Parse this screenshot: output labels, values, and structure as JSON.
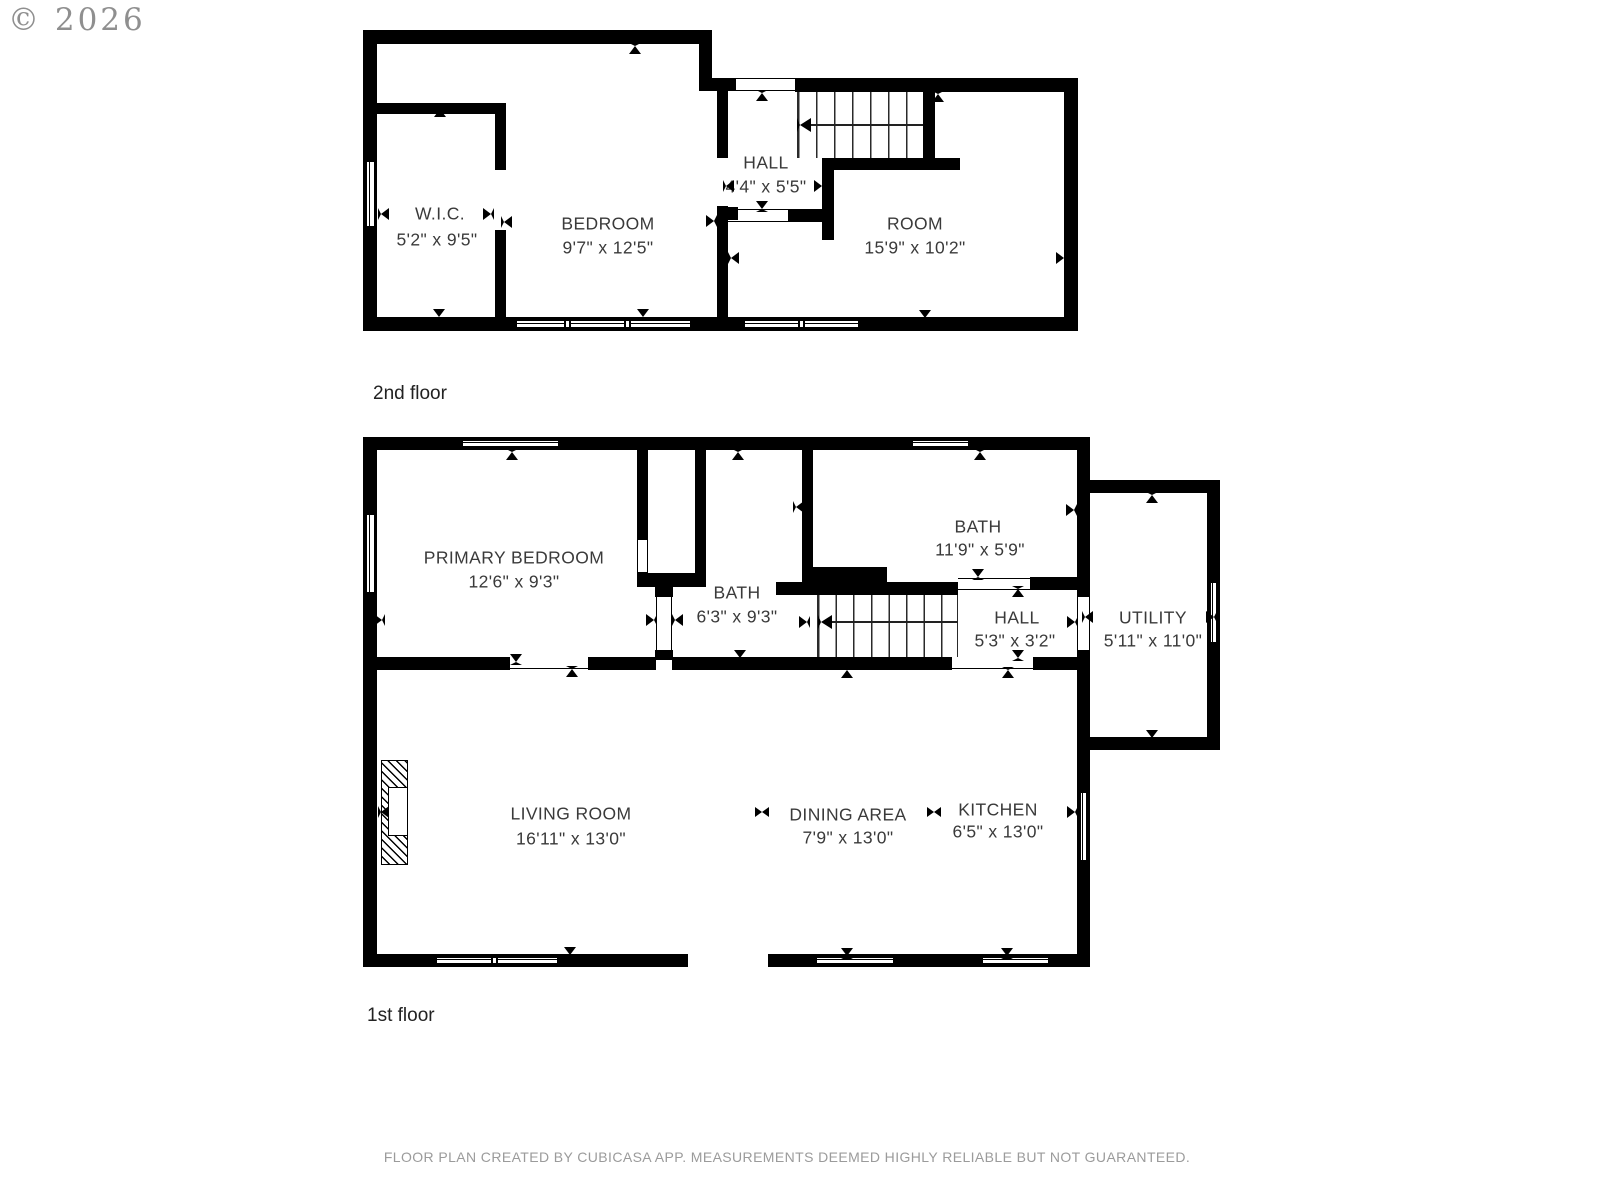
{
  "copyright": "© 2026",
  "floors": [
    {
      "label": "2nd floor",
      "rooms": [
        {
          "name": "W.I.C.",
          "dims": "5'2\" x 9'5\""
        },
        {
          "name": "BEDROOM",
          "dims": "9'7\" x 12'5\""
        },
        {
          "name": "HALL",
          "dims": "4'4\" x 5'5\""
        },
        {
          "name": "ROOM",
          "dims": "15'9\" x 10'2\""
        }
      ]
    },
    {
      "label": "1st floor",
      "rooms": [
        {
          "name": "PRIMARY BEDROOM",
          "dims": "12'6\" x 9'3\""
        },
        {
          "name": "BATH",
          "dims": "6'3\" x 9'3\""
        },
        {
          "name": "BATH",
          "dims": "11'9\" x 5'9\""
        },
        {
          "name": "HALL",
          "dims": "5'3\" x 3'2\""
        },
        {
          "name": "UTILITY",
          "dims": "5'11\" x 11'0\""
        },
        {
          "name": "LIVING ROOM",
          "dims": "16'11\" x 13'0\""
        },
        {
          "name": "DINING AREA",
          "dims": "7'9\" x 13'0\""
        },
        {
          "name": "KITCHEN",
          "dims": "6'5\" x 13'0\""
        }
      ]
    }
  ],
  "footer": "FLOOR PLAN CREATED BY CUBICASA APP. MEASUREMENTS DEEMED HIGHLY RELIABLE BUT NOT GUARANTEED.",
  "colors": {
    "wall": "#000000",
    "label": "#3a3a3a",
    "muted": "#9b9b9b"
  }
}
